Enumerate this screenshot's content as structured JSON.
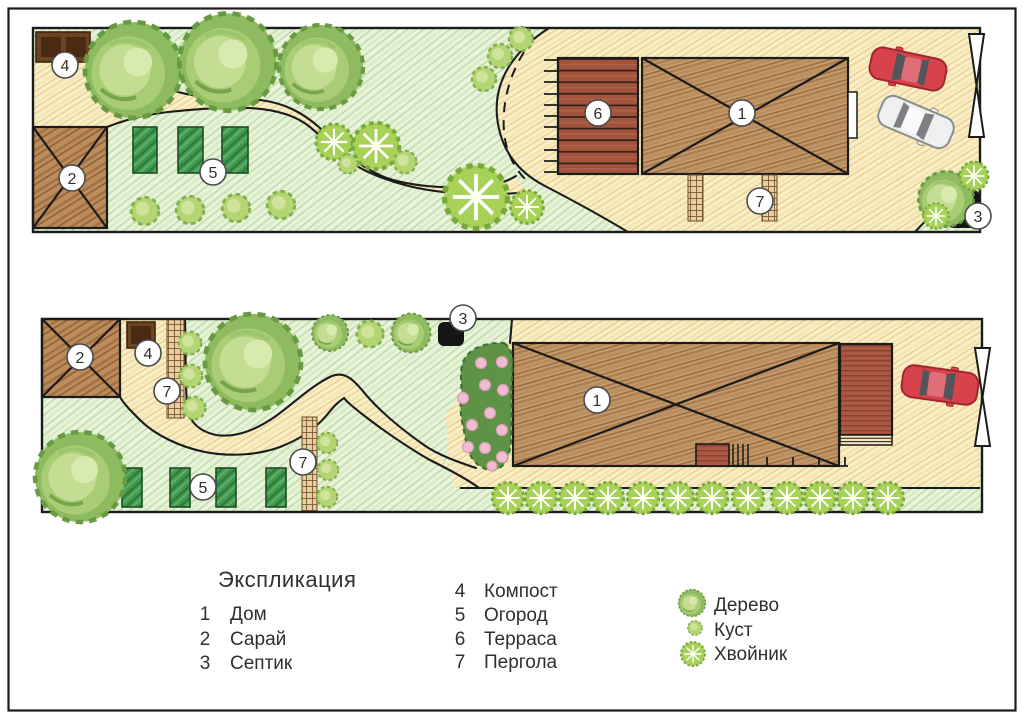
{
  "legend": {
    "title": "Экспликация",
    "items": [
      {
        "num": "1",
        "label": "Дом"
      },
      {
        "num": "2",
        "label": "Сарай"
      },
      {
        "num": "3",
        "label": "Септик"
      },
      {
        "num": "4",
        "label": "Компост"
      },
      {
        "num": "5",
        "label": "Огород"
      },
      {
        "num": "6",
        "label": "Терраса"
      },
      {
        "num": "7",
        "label": "Пергола"
      }
    ],
    "symbols": [
      {
        "icon": "tree-icon",
        "label": "Дерево"
      },
      {
        "icon": "bush-icon",
        "label": "Куст"
      },
      {
        "icon": "conifer-icon",
        "label": "Хвойник"
      }
    ]
  },
  "plans": {
    "variant1": {
      "markers": {
        "house": "1",
        "shed": "2",
        "septic": "3",
        "compost": "4",
        "garden": "5",
        "terrace": "6",
        "pergola": "7"
      }
    },
    "variant2": {
      "markers": {
        "house": "1",
        "shed": "2",
        "septic": "3",
        "compost": "4",
        "garden": "5",
        "pergola_top": "7",
        "pergola_bottom": "7"
      }
    }
  },
  "colors": {
    "lawn": "#e9f3de",
    "sand": "#f9efca",
    "wood": "#c59c6d",
    "deck": "#a3543d",
    "bed": "#43984f",
    "compost": "#6b4423",
    "septic": "#151515",
    "foliage": "#a9cd74",
    "car_red": "#d7434d",
    "car_white": "#efefef"
  }
}
